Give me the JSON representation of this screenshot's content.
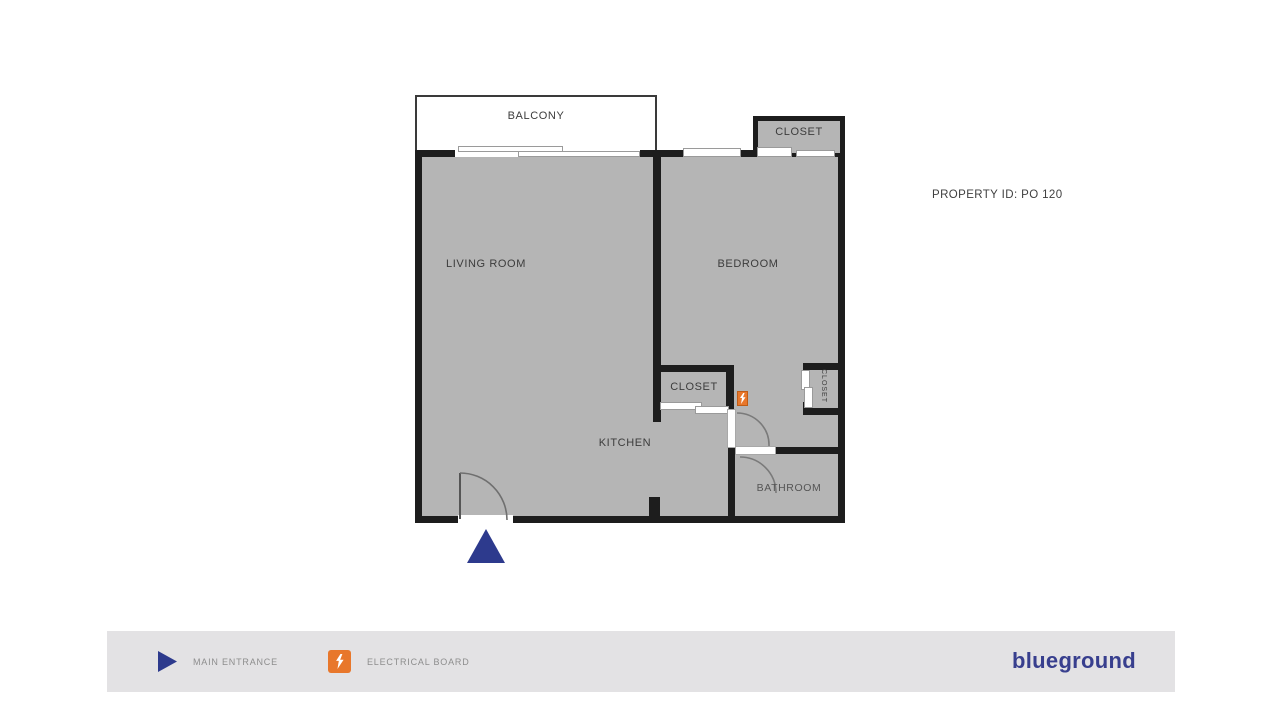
{
  "colors": {
    "wall": "#1d1d1d",
    "room-fill": "#b5b5b5",
    "navy": "#2d3a8d",
    "orange": "#e8772b",
    "footer-bg": "#e3e2e4",
    "label": "#3c3c3c",
    "muted-label": "#8d8d8d",
    "logo-navy": "#383f8e"
  },
  "plan": {
    "property_id": "PROPERTY ID: PO 120",
    "labels": {
      "balcony": "BALCONY",
      "living_room": "LIVING ROOM",
      "bedroom": "BEDROOM",
      "kitchen": "KITCHEN",
      "bathroom": "BATHROOM",
      "closet_top": "CLOSET",
      "closet_hall": "CLOSET",
      "closet_side": "CLOSET"
    },
    "icons": {
      "entrance_marker": "main-entrance-triangle",
      "electrical_marker": "electrical-board"
    }
  },
  "legend": {
    "items": [
      {
        "icon": "main-entrance-triangle",
        "label": "MAIN ENTRANCE"
      },
      {
        "icon": "electrical-board",
        "label": "ELECTRICAL BOARD"
      }
    ]
  },
  "brand": {
    "logo_text": "blueground"
  }
}
